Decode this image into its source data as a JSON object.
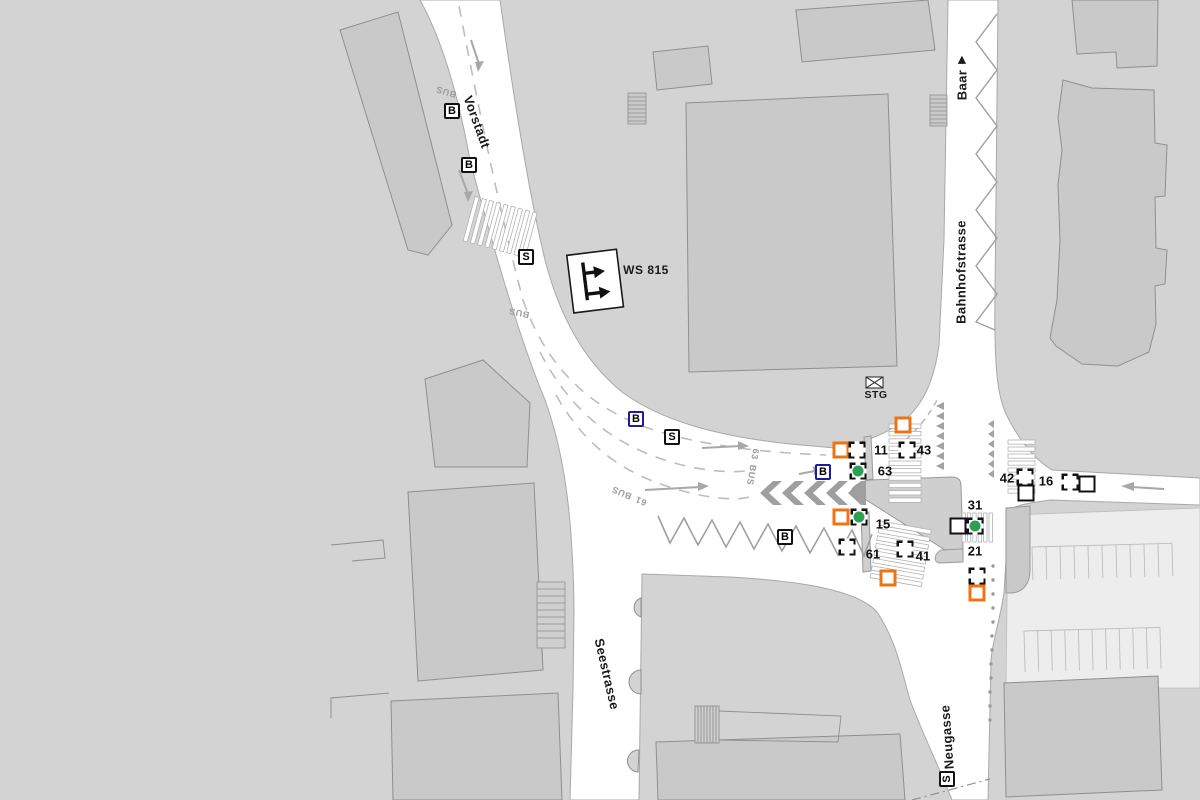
{
  "map": {
    "street_labels": {
      "vorstadt": "Vorstadt",
      "bahnhofstrasse": "Bahnhofstrasse",
      "seestrasse": "Seestrasse",
      "neugasse": "Neugasse"
    },
    "direction_sign": {
      "label": "Baar",
      "arrow_glyph": "▶"
    },
    "traffic_sign": {
      "ws815": "WS 815"
    },
    "controller_box": {
      "label": "STG"
    },
    "symbol_boxes": {
      "bus_letter": "B",
      "signal_letter": "S"
    },
    "lane_text": {
      "bus": "BUS",
      "line_63": "63",
      "line_61": "61"
    },
    "signal_labels": [
      {
        "label": "11"
      },
      {
        "label": "43"
      },
      {
        "label": "63"
      },
      {
        "label": "15"
      },
      {
        "label": "61"
      },
      {
        "label": "41"
      },
      {
        "label": "31"
      },
      {
        "label": "21"
      },
      {
        "label": "42"
      },
      {
        "label": "16"
      }
    ],
    "colors": {
      "background": "#d3d3d3",
      "building": "#c9c9c9",
      "street": "#ffffff",
      "marker_orange": "#ec7414",
      "marker_green": "#2f9e57",
      "marker_blue_border": "#1c1ca0"
    }
  }
}
